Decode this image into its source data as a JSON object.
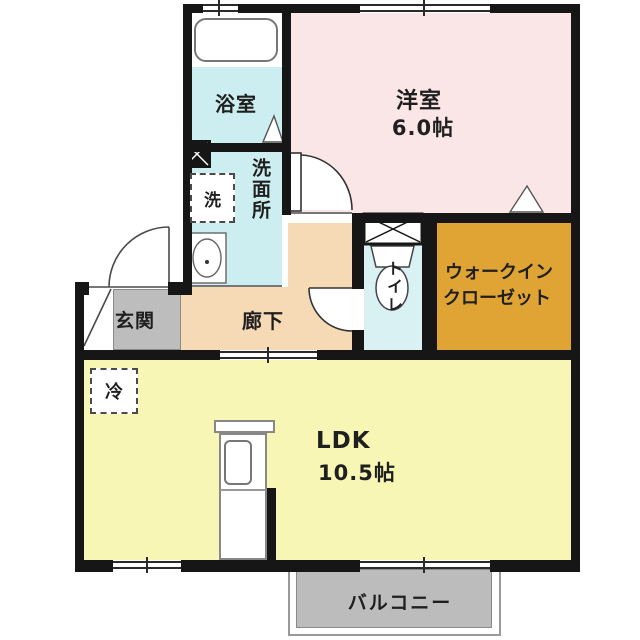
{
  "plan": {
    "type": "japanese-apartment-floorplan",
    "rooms": {
      "bath": {
        "label": "浴室"
      },
      "western_room": {
        "label": "洋室",
        "size": "6.0帖"
      },
      "washroom": {
        "label": "洗面所"
      },
      "washer": {
        "label": "洗"
      },
      "hallway": {
        "label": "廊下"
      },
      "entrance": {
        "label": "玄関"
      },
      "toilet": {
        "label": "トイレ"
      },
      "walk_in_closet": {
        "label_line1": "ウォークイン",
        "label_line2": "クローゼット"
      },
      "ldk": {
        "label": "LDK",
        "size": "10.5帖"
      },
      "refrigerator": {
        "label": "冷"
      },
      "balcony": {
        "label": "バルコニー"
      }
    },
    "colors": {
      "wall": "#161616",
      "bath": "#cdeef0",
      "western_room": "#fae6e6",
      "washroom": "#cdeef0",
      "hallway": "#f6d9b5",
      "entrance": "#bdbdbd",
      "toilet": "#d9f1f3",
      "walk_in_closet": "#dfa434",
      "ldk": "#f7f6b4",
      "balcony": "#bcbcbc"
    }
  }
}
